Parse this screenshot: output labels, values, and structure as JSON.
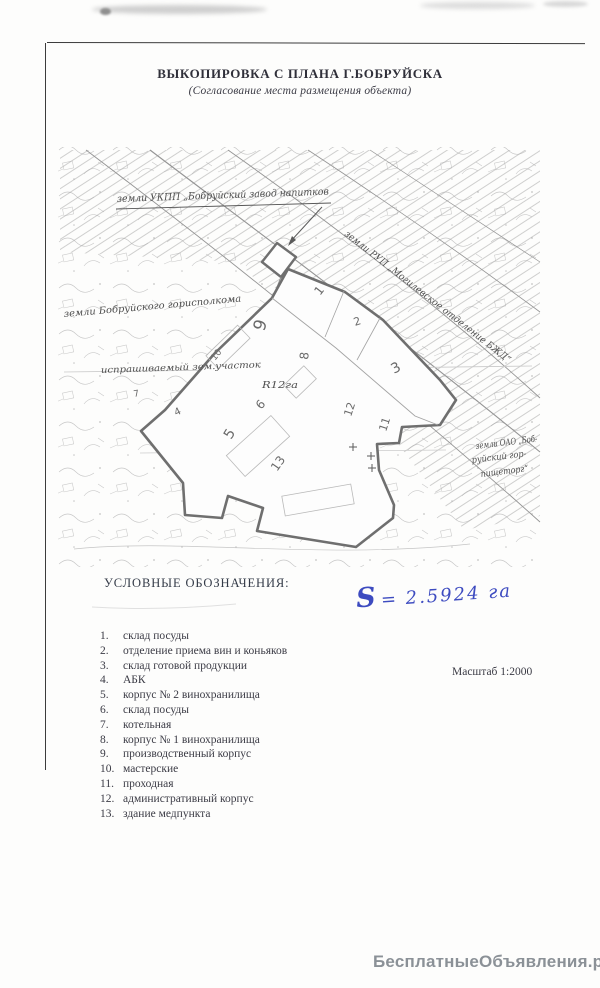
{
  "document": {
    "title": "ВЫКОПИРОВКА С ПЛАНА Г.БОБРУЙСКА",
    "subtitle": "(Согласование места размещения объекта)"
  },
  "map": {
    "label_top": "земли УКПП „Бобруйский завод напитков",
    "label_railway": "земли РУП „Могилевское отделение БЖД“",
    "label_left": "земли Бобруйского горисполкома",
    "label_plot": "испрашиваемый зем.участок",
    "label_plot_area": "R12га",
    "label_right_line1": "земли ОАО „Боб-",
    "label_right_line2": "руйский гор-",
    "label_right_line3": "пищеторг“",
    "numbers": [
      "1",
      "2",
      "3",
      "4",
      "5",
      "6",
      "7",
      "8",
      "9",
      "10",
      "11",
      "12",
      "13"
    ]
  },
  "legend": {
    "heading": "УСЛОВНЫЕ ОБОЗНАЧЕНИЯ:",
    "items": [
      {
        "num": "1.",
        "label": "склад посуды"
      },
      {
        "num": "2.",
        "label": "отделение приема вин и коньяков"
      },
      {
        "num": "3.",
        "label": "склад готовой продукции"
      },
      {
        "num": "4.",
        "label": "АБК"
      },
      {
        "num": "5.",
        "label": "корпус № 2 винохранилища"
      },
      {
        "num": "6.",
        "label": "склад посуды"
      },
      {
        "num": "7.",
        "label": "котельная"
      },
      {
        "num": "8.",
        "label": "корпус № 1 винохранилища"
      },
      {
        "num": "9.",
        "label": "производственный корпус"
      },
      {
        "num": "10.",
        "label": "мастерские"
      },
      {
        "num": "11.",
        "label": "проходная"
      },
      {
        "num": "12.",
        "label": "административный корпус"
      },
      {
        "num": "13.",
        "label": "здание медпункта"
      }
    ]
  },
  "annotations": {
    "area_note_s": "S",
    "area_note_value": "= 2.5924 га",
    "scale": "Масштаб 1:2000"
  },
  "watermark": "БесплатныеОбъявления.рф"
}
